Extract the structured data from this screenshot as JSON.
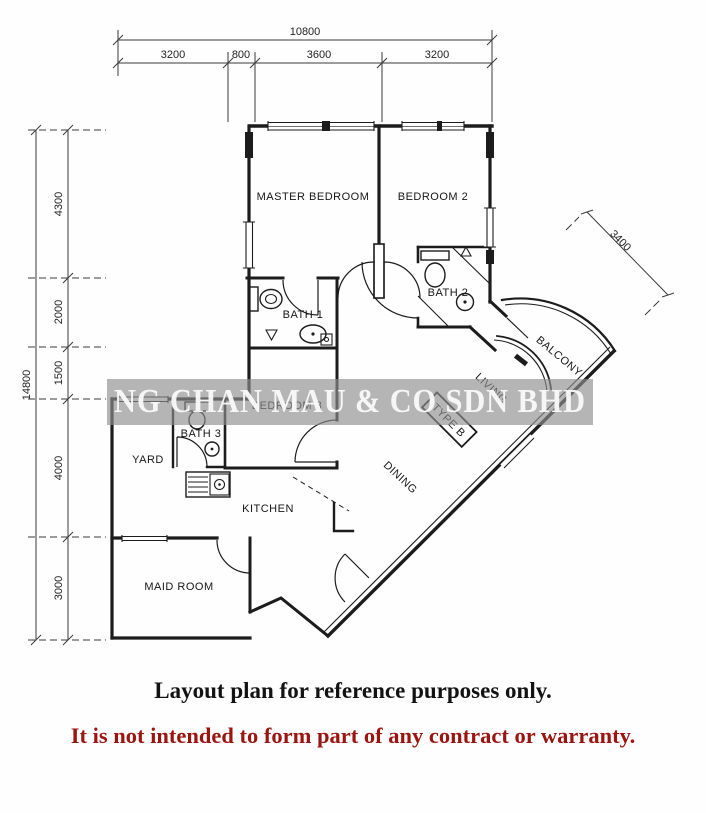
{
  "plan": {
    "rooms": {
      "master_bedroom": "MASTER BEDROOM",
      "bedroom2": "BEDROOM 2",
      "bedroom3": "BEDROOM 3",
      "bath1": "BATH 1",
      "bath2": "BATH 2",
      "bath3": "BATH 3",
      "yard": "YARD",
      "kitchen": "KITCHEN",
      "maid_room": "MAID ROOM",
      "dining": "DINING",
      "living": "LIVING",
      "balcony": "BALCONY",
      "unit_type": "TYPE B"
    },
    "dimensions": {
      "top": {
        "total": "10800",
        "segments": [
          "3200",
          "800",
          "3600",
          "3200"
        ]
      },
      "left": {
        "total": "14800",
        "segments": [
          "4300",
          "2000",
          "1500",
          "4000",
          "3000"
        ]
      },
      "diagonal": "3400"
    },
    "watermark": {
      "text": "NG CHAN MAU & CO SDN BHD",
      "band_color": "#8f8f8f",
      "text_color": "#fafafa"
    },
    "captions": {
      "line1": "Layout plan for reference purposes only.",
      "line1_color": "#131313",
      "line2": "It is not intended to form part of any contract or warranty.",
      "line2_color": "#9b140f"
    }
  }
}
